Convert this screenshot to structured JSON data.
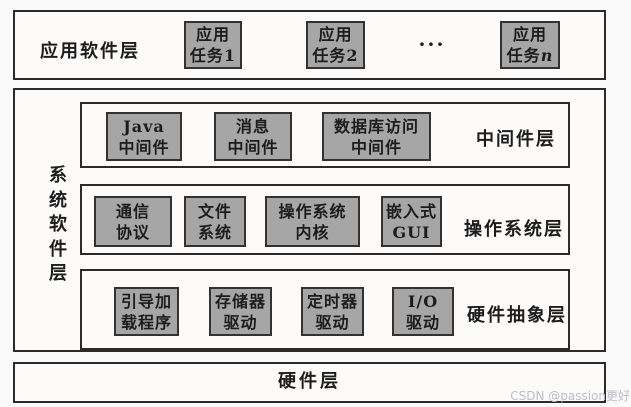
{
  "watermark": "CSDN @passion更好",
  "colors": {
    "background": "#fbfafa",
    "box_fill": "#a6a6a6",
    "box_border": "#323232",
    "outline": "#2b2b2b",
    "watermark": "#bcbdcb"
  },
  "app_layer": {
    "label": "应用软件层",
    "ellipsis": "···",
    "tasks": [
      {
        "top": "应用",
        "bottom": "任务1",
        "suffix": ""
      },
      {
        "top": "应用",
        "bottom": "任务2",
        "suffix": ""
      },
      {
        "top": "应用",
        "bottom": "任务",
        "suffix": "n"
      }
    ]
  },
  "system_layer": {
    "label": "系统软件层",
    "sublayers": [
      {
        "name": "中间件层",
        "boxes": [
          {
            "top": "Java",
            "bottom": "中间件"
          },
          {
            "top": "消息",
            "bottom": "中间件"
          },
          {
            "top": "数据库访问",
            "bottom": "中间件"
          }
        ]
      },
      {
        "name": "操作系统层",
        "boxes": [
          {
            "top": "通信",
            "bottom": "协议"
          },
          {
            "top": "文件",
            "bottom": "系统"
          },
          {
            "top": "操作系统",
            "bottom": "内核"
          },
          {
            "top": "嵌入式",
            "bottom": "GUI"
          }
        ]
      },
      {
        "name": "硬件抽象层",
        "boxes": [
          {
            "top": "引导加",
            "bottom": "载程序"
          },
          {
            "top": "存储器",
            "bottom": "驱动"
          },
          {
            "top": "定时器",
            "bottom": "驱动"
          },
          {
            "top": "I/O",
            "bottom": "驱动"
          }
        ]
      }
    ]
  },
  "hardware_layer": {
    "label": "硬件层"
  }
}
